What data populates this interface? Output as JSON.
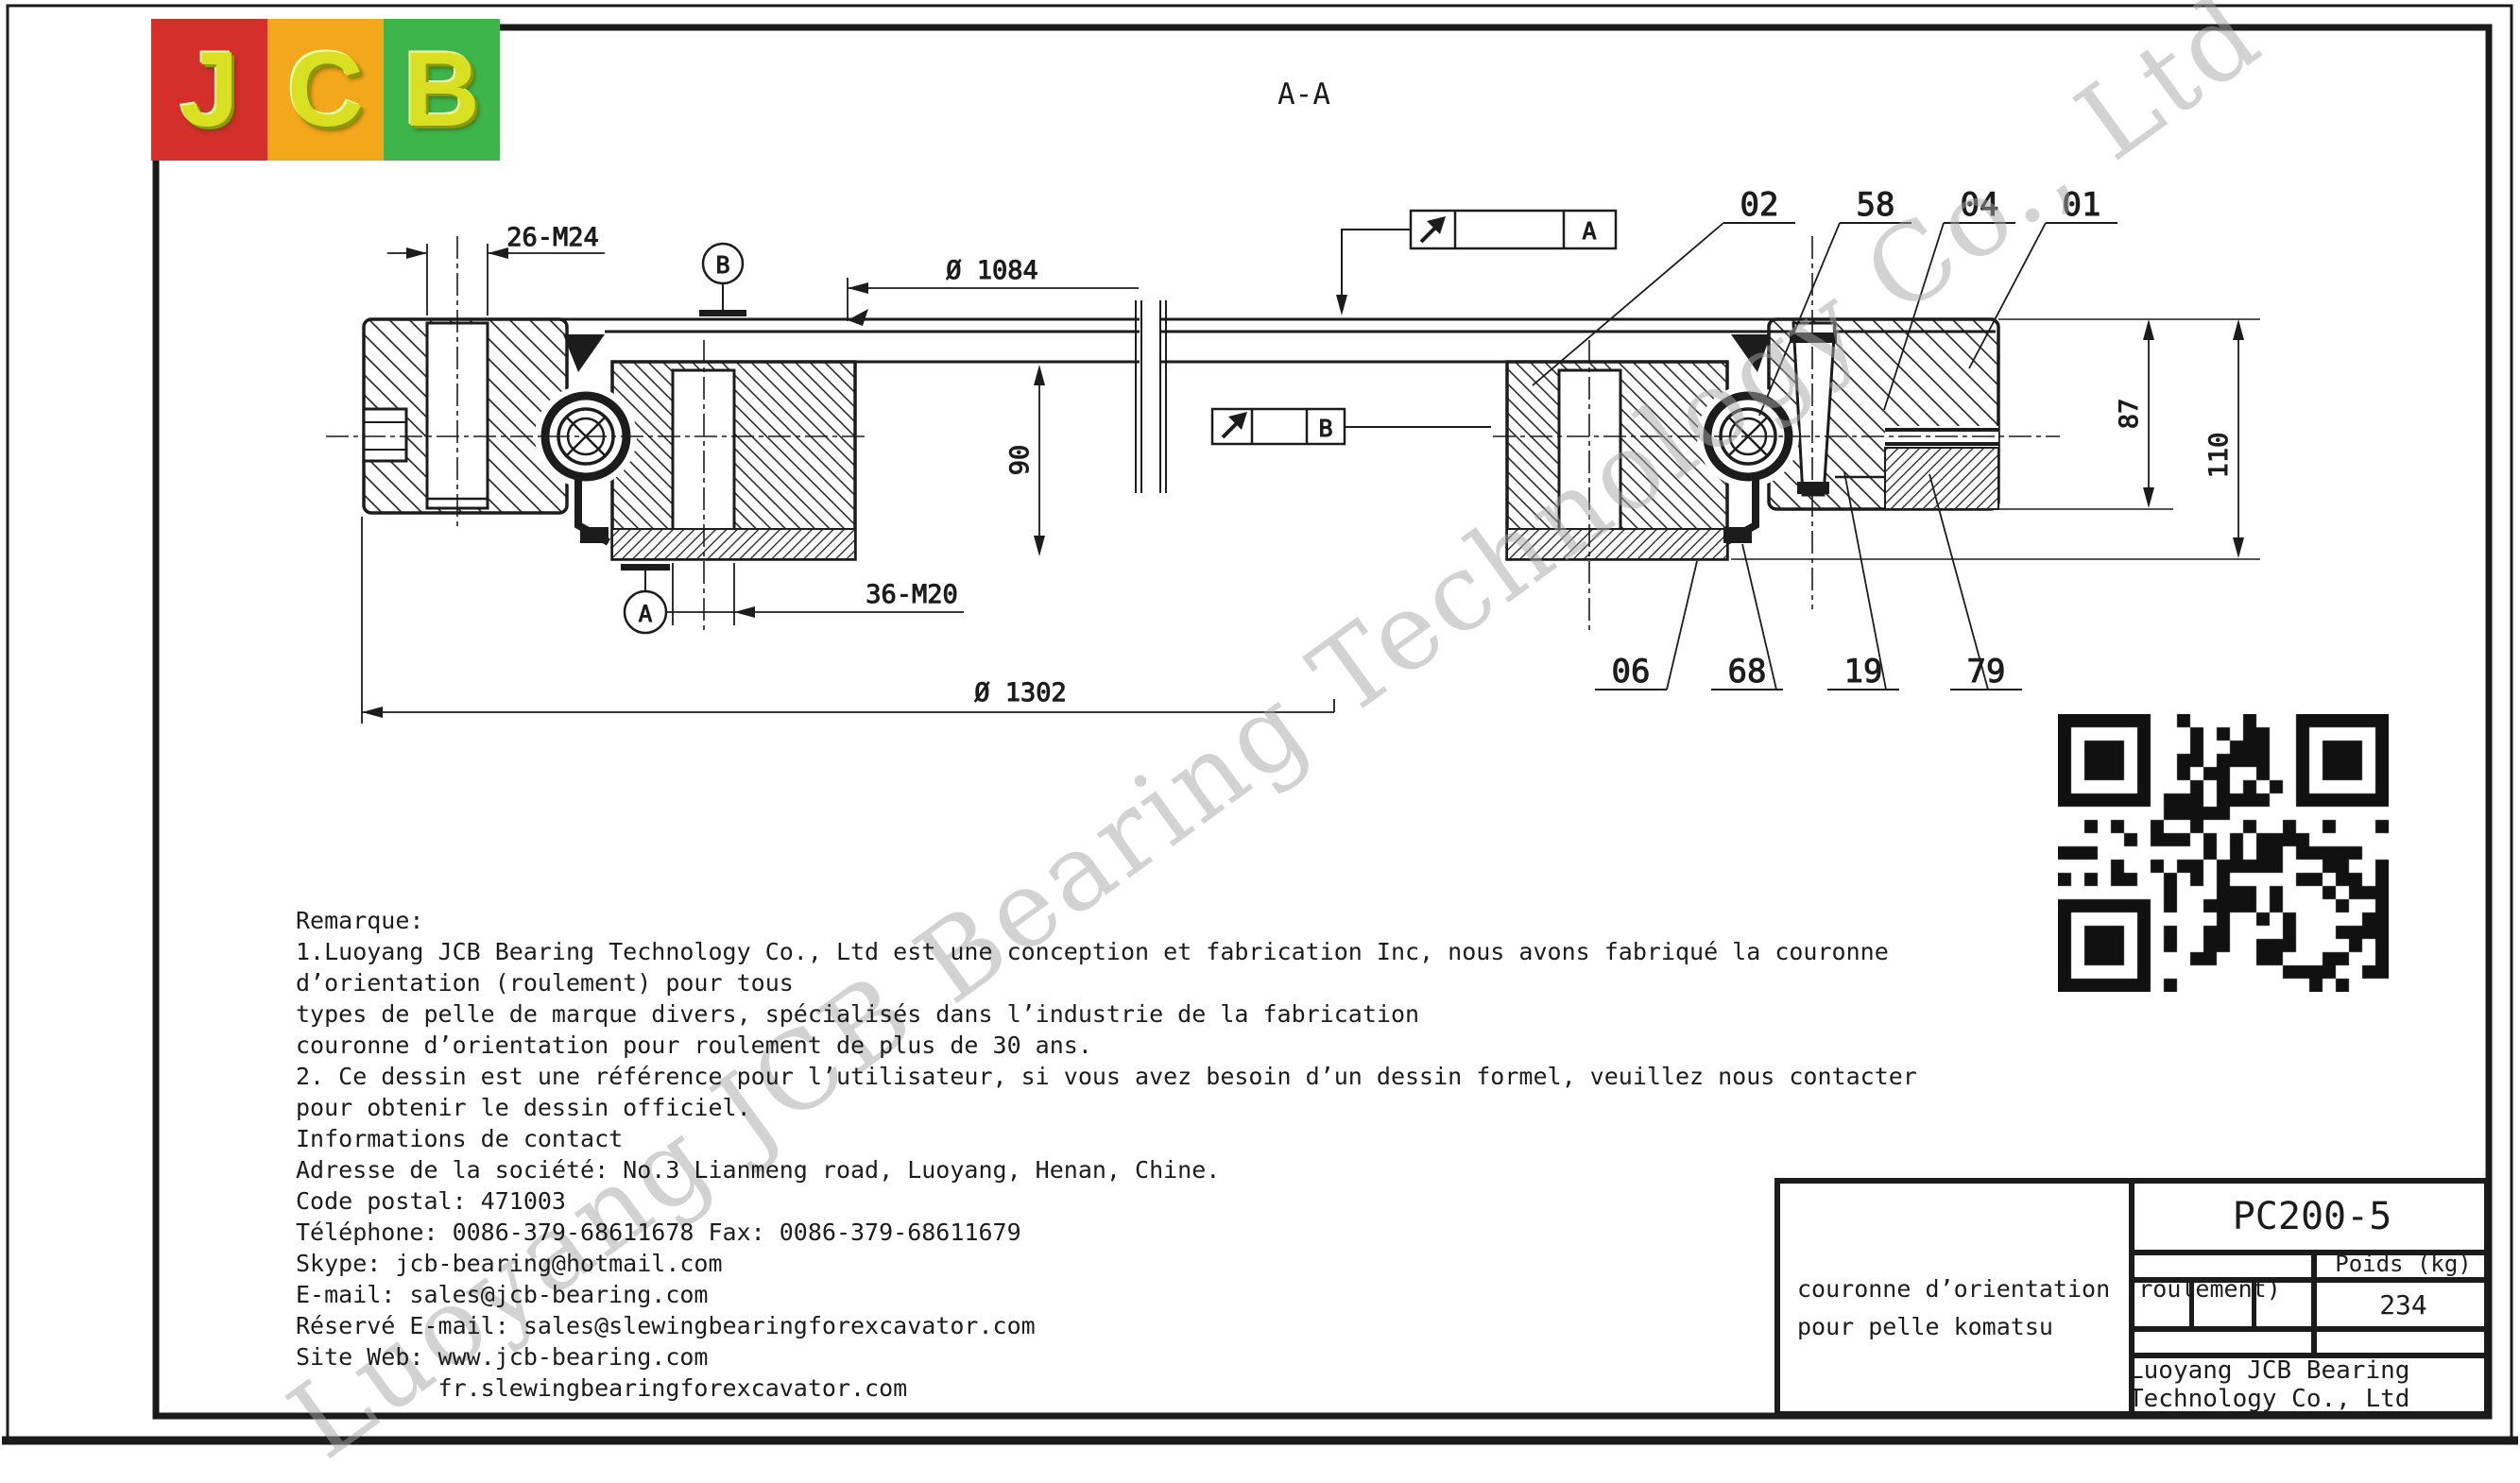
{
  "logo": {
    "letters": [
      "J",
      "C",
      "B"
    ],
    "panel_colors": [
      "#d42f2b",
      "#f3a71b",
      "#3eb54a"
    ],
    "letter_color": "#d9e021"
  },
  "watermark": {
    "text": "Luoyang JCB Bearing Technology Co., Ltd"
  },
  "drawing": {
    "section_title": "A-A",
    "dims": {
      "bolt_top": "26-M24",
      "bore": "Ø 1084",
      "inner_height": "90",
      "bolt_bottom": "36-M20",
      "outer_dia": "Ø 1302",
      "outer_height": "87",
      "total_height": "110"
    },
    "datums": {
      "a": "A",
      "b": "B"
    },
    "section_boxes": {
      "a": "A",
      "b": "B"
    },
    "part_labels_top": [
      "02",
      "58",
      "04",
      "01"
    ],
    "part_labels_bottom": [
      "06",
      "68",
      "19",
      "79"
    ]
  },
  "remarks": {
    "lines": [
      "Remarque:",
      "1.Luoyang JCB Bearing Technology Co., Ltd est une conception et fabrication Inc, nous avons fabriqué la couronne",
      "d’orientation (roulement) pour tous",
      "types de pelle de marque divers, spécialisés dans l’industrie de la fabrication",
      "couronne d’orientation pour roulement de plus de 30 ans.",
      "2. Ce dessin est une référence pour l’utilisateur, si vous avez besoin d’un dessin formel, veuillez nous contacter",
      "pour obtenir le dessin officiel.",
      "Informations de contact",
      "Adresse de la société: No.3 Lianmeng road, Luoyang, Henan, Chine.",
      "Code postal: 471003",
      "Téléphone: 0086-379-68611678 Fax: 0086-379-68611679",
      "Skype: jcb-bearing@hotmail.com",
      "E-mail: sales@jcb-bearing.com",
      "Réservé E-mail: sales@slewingbearingforexcavator.com",
      "Site Web: www.jcb-bearing.com",
      "          fr.slewingbearingforexcavator.com"
    ]
  },
  "title_block": {
    "part_no": "PC200-5",
    "weight_label": "Poids (kg)",
    "weight_value": "234",
    "desc_line1": "couronne d’orientation (roulement)",
    "desc_line2": "pour pelle komatsu",
    "company": "Luoyang JCB Bearing Technology Co., Ltd"
  }
}
